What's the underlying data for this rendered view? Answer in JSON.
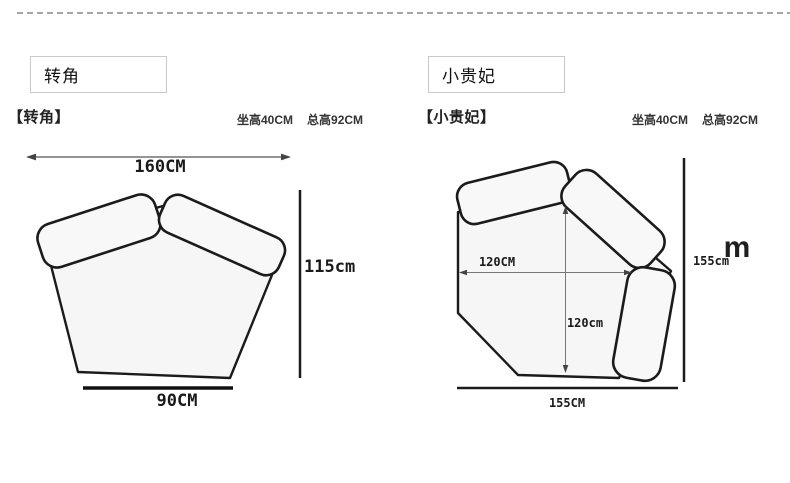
{
  "panels": [
    {
      "tag_label": "转角",
      "title": "【转角】",
      "spec_seat": "坐高40CM",
      "spec_total": "总高92CM",
      "dims": {
        "width": "160CM",
        "height": "115cm",
        "bottom": "90CM"
      }
    },
    {
      "tag_label": "小贵妃",
      "title": "【小贵妃】",
      "spec_seat": "坐高40CM",
      "spec_total": "总高92CM",
      "dims": {
        "inner_width": "120CM",
        "inner_depth": "120cm",
        "bottom": "155CM",
        "height": "155cm"
      }
    }
  ],
  "watermark": "m",
  "colors": {
    "outline": "#1b1b1b",
    "shape_fill": "#f6f6f6",
    "divider": "#a6a6a6"
  }
}
